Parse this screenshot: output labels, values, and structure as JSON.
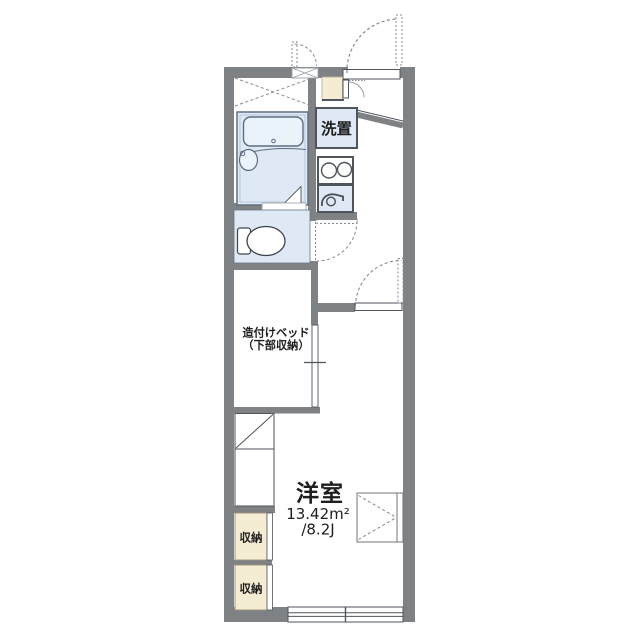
{
  "floorplan": {
    "labels": {
      "laundry": "洗置",
      "bed_line1": "造付けベッド",
      "bed_line2": "（下部収納）",
      "main_room": "洋室",
      "area_sqm": "13.42m²",
      "area_jo": "/8.2J",
      "storage_upper": "収納",
      "storage_lower": "収納"
    },
    "colors": {
      "wall": "#7f8285",
      "room-blue": "#dfe9f6",
      "room-blue-light": "#eaf2fa",
      "cream": "#f5ecd4",
      "line": "#4e555c",
      "fixture": "#5e6e80",
      "dash": "#85898d",
      "text": "#1e1e1e"
    }
  }
}
